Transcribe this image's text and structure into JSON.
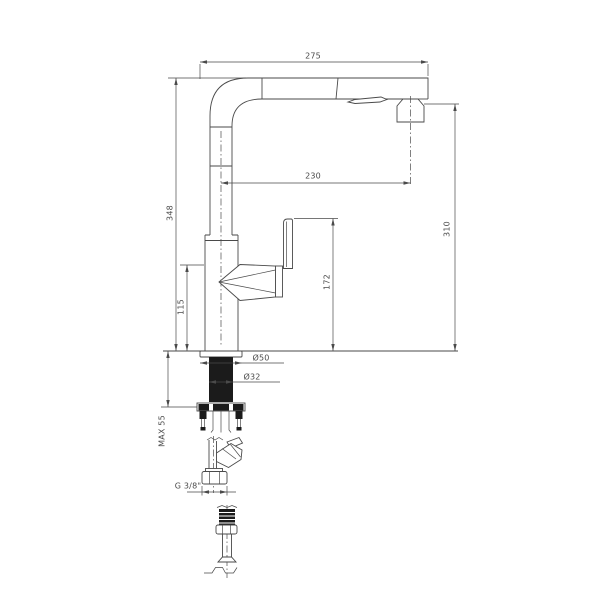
{
  "colors": {
    "line": "#4a4a4a",
    "dark_fill": "#1b1b1b",
    "background": "#ffffff"
  },
  "labels": {
    "reach_overall": "275",
    "reach_to_spray_center": "230",
    "height_total": "348",
    "height_spray_outlet": "310",
    "height_lever_top": "172",
    "height_body_joint": "115",
    "max_deck_thickness": "MAX 55",
    "base_diameter": "Ø50",
    "shank_diameter": "Ø32",
    "hose_thread": "G 3/8\""
  }
}
